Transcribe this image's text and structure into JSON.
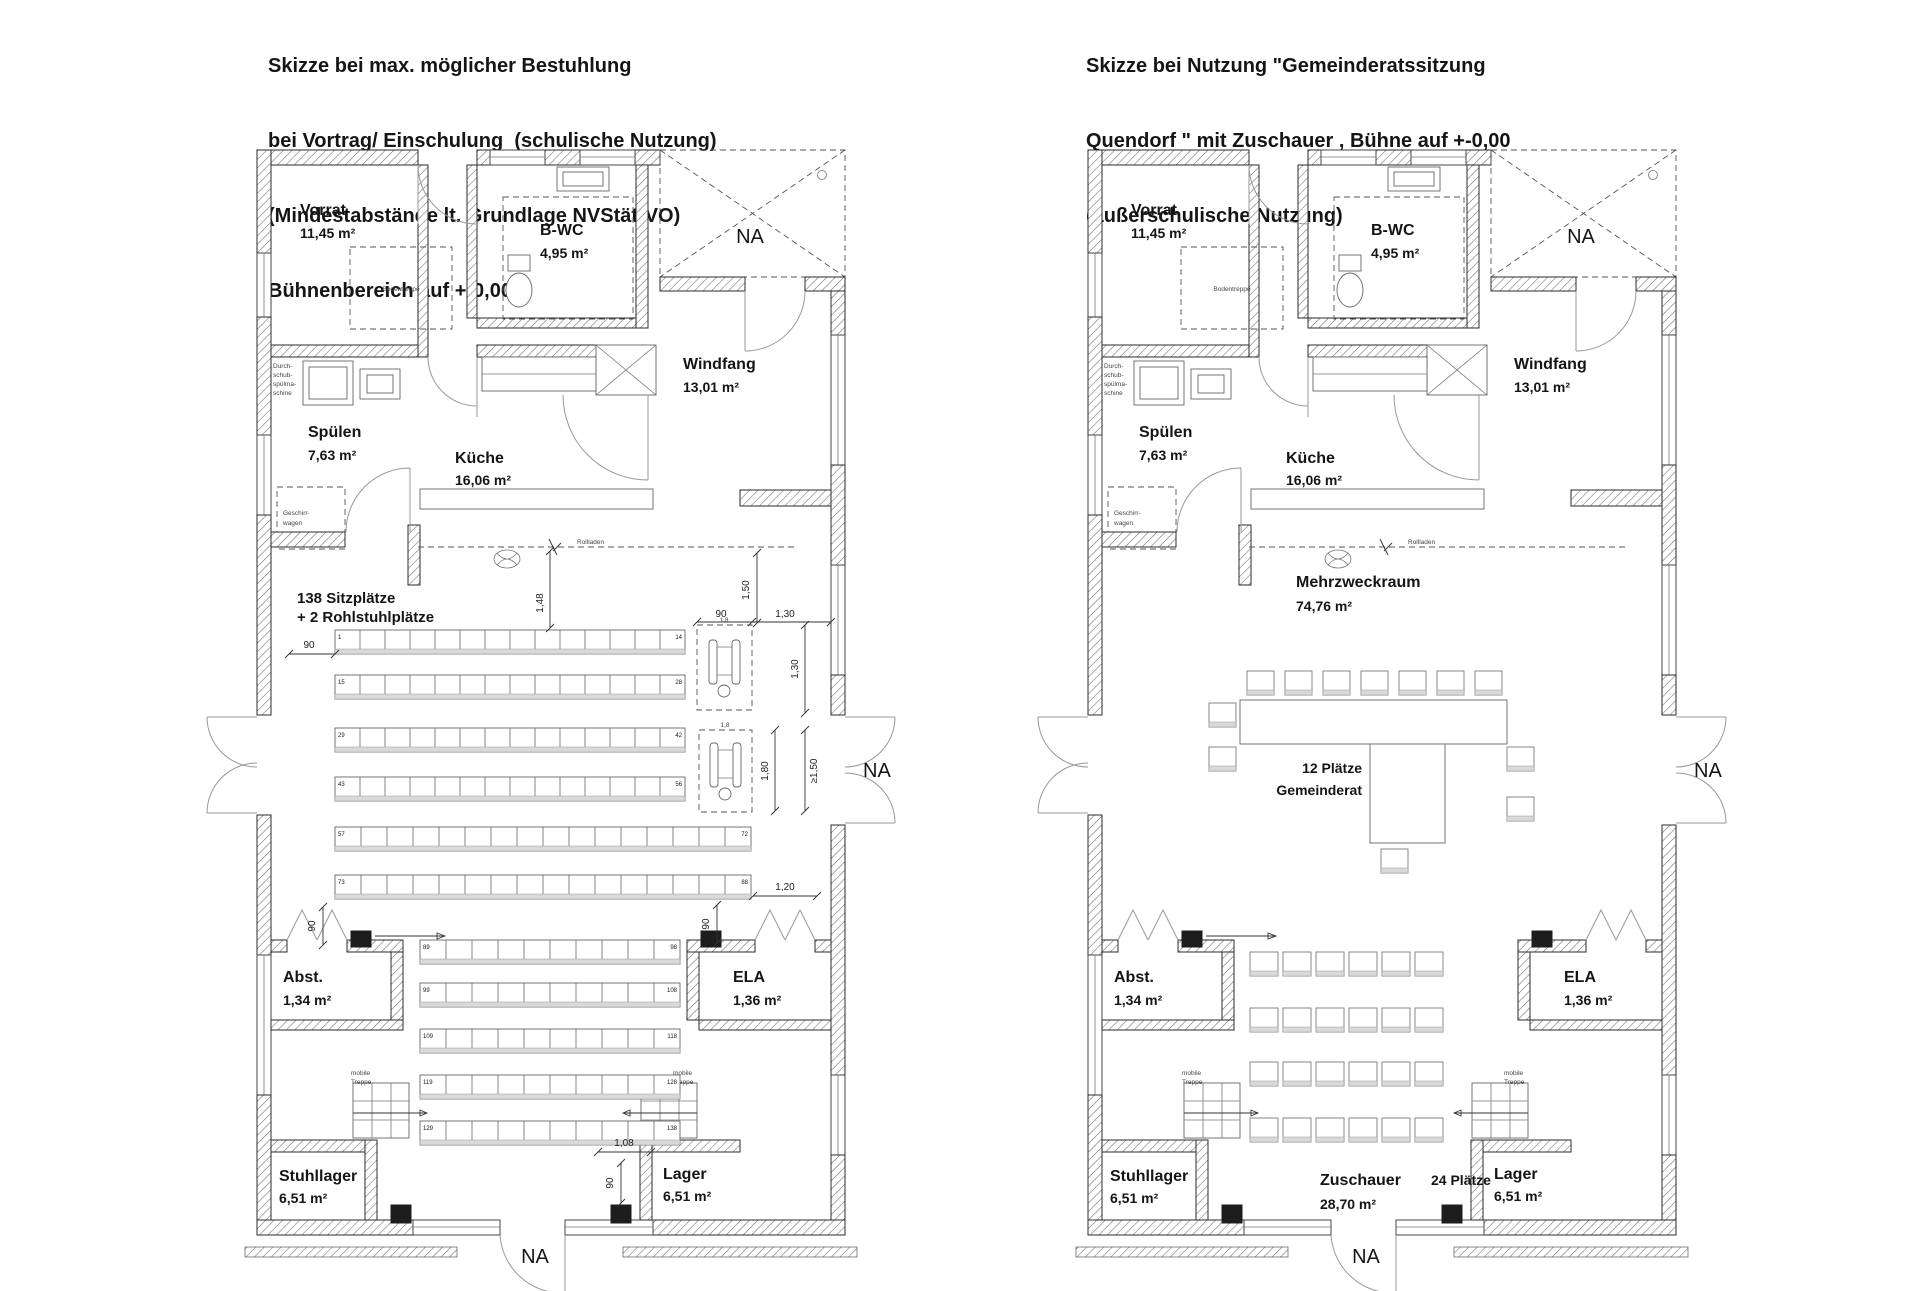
{
  "titles": {
    "left": [
      "Skizze bei max. möglicher Bestuhlung",
      "bei Vortrag/ Einschulung  (schulische Nutzung)",
      "(Mindestabstände lt. Grundlage NVStättVO)",
      "Bühnenbereich auf +-0,00"
    ],
    "right": [
      "Skizze bei Nutzung \"Gemeinderatssitzung",
      "Quendorf \" mit Zuschauer , Bühne auf +-0,00",
      "(außerschulische Nutzung)"
    ]
  },
  "rooms": {
    "vorrat": {
      "name": "Vorrat",
      "area": "11,45 m²"
    },
    "bwc": {
      "name": "B-WC",
      "area": "4,95 m²"
    },
    "windfang": {
      "name": "Windfang",
      "area": "13,01 m²"
    },
    "spuelen": {
      "name": "Spülen",
      "area": "7,63 m²"
    },
    "kueche": {
      "name": "Küche",
      "area": "16,06 m²"
    },
    "abst": {
      "name": "Abst.",
      "area": "1,34 m²"
    },
    "ela": {
      "name": "ELA",
      "area": "1,36 m²"
    },
    "stuhllager": {
      "name": "Stuhllager",
      "area": "6,51 m²"
    },
    "lager": {
      "name": "Lager",
      "area": "6,51 m²"
    }
  },
  "annotations": {
    "na": "NA",
    "bodentreppe": "Bodentreppe",
    "rollladen": "Rollladen",
    "durchschub": [
      "Durch-",
      "schub-",
      "spülma-",
      "schine"
    ],
    "geschirrwagen": [
      "Geschirr-",
      "wagen"
    ],
    "mobile_treppe": [
      "mobile",
      "Treppe"
    ],
    "wheelchair_width": "1,8"
  },
  "left_plan": {
    "note": [
      "138 Sitzplätze",
      "+ 2 Rohlstuhlplätze"
    ],
    "dims": {
      "d90_rows": "90",
      "d148": "1,48",
      "d150": "1,50",
      "d90_wc": "90",
      "d130_wc": "1,30",
      "d130_v": "1,30",
      "d180": "1,80",
      "dmin150": "≥1,50",
      "d120": "1,20",
      "d90_ela": "90",
      "d90_abst": "90",
      "d108": "1,08",
      "d90_lager": "90"
    },
    "seat_rows": [
      {
        "x": 130,
        "y": 495,
        "count": 14,
        "w": 25,
        "start": "1",
        "end": "14"
      },
      {
        "x": 130,
        "y": 540,
        "count": 14,
        "w": 25,
        "start": "15",
        "end": "28"
      },
      {
        "x": 130,
        "y": 593,
        "count": 14,
        "w": 25,
        "start": "29",
        "end": "42"
      },
      {
        "x": 130,
        "y": 642,
        "count": 14,
        "w": 25,
        "start": "43",
        "end": "56"
      },
      {
        "x": 130,
        "y": 692,
        "count": 16,
        "w": 26,
        "start": "57",
        "end": "72"
      },
      {
        "x": 130,
        "y": 740,
        "count": 16,
        "w": 26,
        "start": "73",
        "end": "88"
      },
      {
        "x": 215,
        "y": 805,
        "count": 10,
        "w": 26,
        "start": "89",
        "end": "98"
      },
      {
        "x": 215,
        "y": 848,
        "count": 10,
        "w": 26,
        "start": "99",
        "end": "108"
      },
      {
        "x": 215,
        "y": 894,
        "count": 10,
        "w": 26,
        "start": "109",
        "end": "118"
      },
      {
        "x": 215,
        "y": 940,
        "count": 10,
        "w": 26,
        "start": "119",
        "end": "128"
      },
      {
        "x": 215,
        "y": 986,
        "count": 10,
        "w": 26,
        "start": "129",
        "end": "138"
      }
    ]
  },
  "right_plan": {
    "mehrzweckraum": {
      "name": "Mehrzweckraum",
      "area": "74,76 m²"
    },
    "table_label": [
      "12 Plätze",
      "Gemeinderat"
    ],
    "zuschauer": {
      "label": "Zuschauer",
      "seats": "24 Plätze",
      "area": "28,70 m²"
    },
    "zuschauer_grid": {
      "cols": 6,
      "rows": 4,
      "x": 214,
      "ys": [
        817,
        873,
        927,
        983
      ],
      "stepx": 33,
      "w": 28,
      "h": 24
    }
  }
}
